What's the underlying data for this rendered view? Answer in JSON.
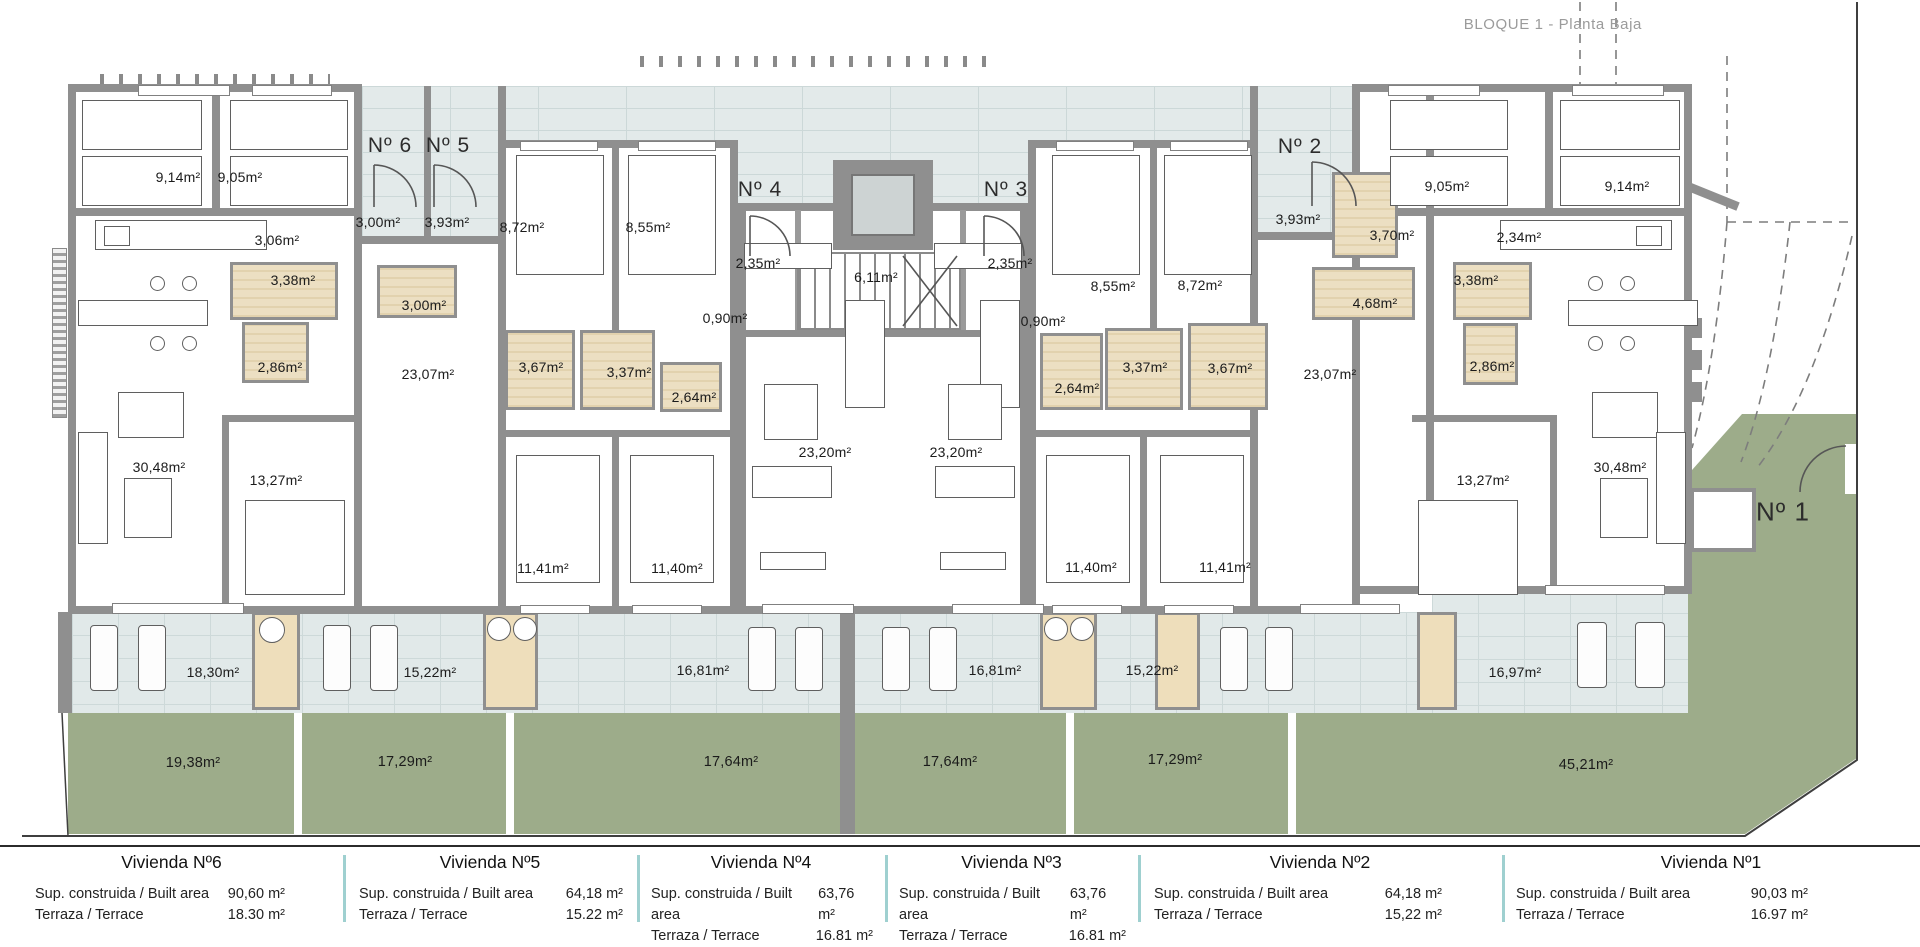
{
  "header": {
    "title": "BLOQUE 1 - Planta Baja"
  },
  "plan": {
    "labels": [
      {
        "kind": "entrance",
        "text": "Nº 6",
        "x": 390,
        "y": 146
      },
      {
        "kind": "entrance",
        "text": "Nº 5",
        "x": 448,
        "y": 146
      },
      {
        "kind": "entrance",
        "text": "Nº 4",
        "x": 760,
        "y": 190
      },
      {
        "kind": "entrance",
        "text": "Nº 3",
        "x": 1006,
        "y": 190
      },
      {
        "kind": "entrance",
        "text": "Nº 2",
        "x": 1300,
        "y": 147
      },
      {
        "kind": "entrance big-entrance",
        "text": "Nº 1",
        "x": 1783,
        "y": 512
      },
      {
        "kind": "room",
        "text": "9,14m²",
        "x": 178,
        "y": 177
      },
      {
        "kind": "room",
        "text": "9,05m²",
        "x": 240,
        "y": 177
      },
      {
        "kind": "room",
        "text": "3,06m²",
        "x": 277,
        "y": 240
      },
      {
        "kind": "room",
        "text": "3,38m²",
        "x": 293,
        "y": 280
      },
      {
        "kind": "room",
        "text": "2,86m²",
        "x": 280,
        "y": 367
      },
      {
        "kind": "room",
        "text": "30,48m²",
        "x": 159,
        "y": 467
      },
      {
        "kind": "room",
        "text": "13,27m²",
        "x": 276,
        "y": 480
      },
      {
        "kind": "room",
        "text": "3,00m²",
        "x": 378,
        "y": 222
      },
      {
        "kind": "room",
        "text": "3,93m²",
        "x": 447,
        "y": 222
      },
      {
        "kind": "room",
        "text": "3,00m²",
        "x": 424,
        "y": 305
      },
      {
        "kind": "room",
        "text": "23,07m²",
        "x": 428,
        "y": 374
      },
      {
        "kind": "room",
        "text": "8,72m²",
        "x": 522,
        "y": 227
      },
      {
        "kind": "room",
        "text": "8,55m²",
        "x": 648,
        "y": 227
      },
      {
        "kind": "room",
        "text": "3,67m²",
        "x": 541,
        "y": 367
      },
      {
        "kind": "room",
        "text": "3,37m²",
        "x": 629,
        "y": 372
      },
      {
        "kind": "room",
        "text": "2,64m²",
        "x": 694,
        "y": 397
      },
      {
        "kind": "room",
        "text": "11,41m²",
        "x": 543,
        "y": 568
      },
      {
        "kind": "room",
        "text": "11,40m²",
        "x": 677,
        "y": 568
      },
      {
        "kind": "room",
        "text": "2,35m²",
        "x": 758,
        "y": 263
      },
      {
        "kind": "room",
        "text": "0,90m²",
        "x": 725,
        "y": 318
      },
      {
        "kind": "room",
        "text": "23,20m²",
        "x": 825,
        "y": 452
      },
      {
        "kind": "room",
        "text": "6,11m²",
        "x": 876,
        "y": 277
      },
      {
        "kind": "room",
        "text": "2,35m²",
        "x": 1010,
        "y": 263
      },
      {
        "kind": "room",
        "text": "0,90m²",
        "x": 1043,
        "y": 321
      },
      {
        "kind": "room",
        "text": "23,20m²",
        "x": 956,
        "y": 452
      },
      {
        "kind": "room",
        "text": "11,40m²",
        "x": 1091,
        "y": 567
      },
      {
        "kind": "room",
        "text": "11,41m²",
        "x": 1225,
        "y": 567
      },
      {
        "kind": "room",
        "text": "8,55m²",
        "x": 1113,
        "y": 286
      },
      {
        "kind": "room",
        "text": "8,72m²",
        "x": 1200,
        "y": 285
      },
      {
        "kind": "room",
        "text": "2,64m²",
        "x": 1077,
        "y": 388
      },
      {
        "kind": "room",
        "text": "3,37m²",
        "x": 1145,
        "y": 367
      },
      {
        "kind": "room",
        "text": "3,67m²",
        "x": 1230,
        "y": 368
      },
      {
        "kind": "room",
        "text": "3,93m²",
        "x": 1298,
        "y": 219
      },
      {
        "kind": "room",
        "text": "3,70m²",
        "x": 1392,
        "y": 235
      },
      {
        "kind": "room",
        "text": "4,68m²",
        "x": 1375,
        "y": 303
      },
      {
        "kind": "room",
        "text": "23,07m²",
        "x": 1330,
        "y": 374
      },
      {
        "kind": "room",
        "text": "9,05m²",
        "x": 1447,
        "y": 186
      },
      {
        "kind": "room",
        "text": "2,34m²",
        "x": 1519,
        "y": 237
      },
      {
        "kind": "room",
        "text": "3,38m²",
        "x": 1476,
        "y": 280
      },
      {
        "kind": "room",
        "text": "2,86m²",
        "x": 1492,
        "y": 366
      },
      {
        "kind": "room",
        "text": "13,27m²",
        "x": 1483,
        "y": 480
      },
      {
        "kind": "room",
        "text": "9,14m²",
        "x": 1627,
        "y": 186
      },
      {
        "kind": "room",
        "text": "30,48m²",
        "x": 1620,
        "y": 467
      },
      {
        "kind": "room",
        "text": "18,30m²",
        "x": 213,
        "y": 672
      },
      {
        "kind": "room",
        "text": "15,22m²",
        "x": 430,
        "y": 672
      },
      {
        "kind": "room",
        "text": "16,81m²",
        "x": 703,
        "y": 670
      },
      {
        "kind": "room",
        "text": "16,81m²",
        "x": 995,
        "y": 670
      },
      {
        "kind": "room",
        "text": "15,22m²",
        "x": 1152,
        "y": 670
      },
      {
        "kind": "room",
        "text": "16,97m²",
        "x": 1515,
        "y": 672
      },
      {
        "kind": "garden",
        "text": "19,38m²",
        "x": 193,
        "y": 763
      },
      {
        "kind": "garden",
        "text": "17,29m²",
        "x": 405,
        "y": 762
      },
      {
        "kind": "garden",
        "text": "17,64m²",
        "x": 731,
        "y": 762
      },
      {
        "kind": "garden",
        "text": "17,64m²",
        "x": 950,
        "y": 762
      },
      {
        "kind": "garden",
        "text": "17,29m²",
        "x": 1175,
        "y": 760
      },
      {
        "kind": "garden",
        "text": "45,21m²",
        "x": 1586,
        "y": 765
      }
    ]
  },
  "legend_table": {
    "built_label": "Sup. construida / Built area",
    "terrace_label": "Terraza / Terrace",
    "columns": [
      {
        "title": "Vivienda Nº6",
        "built": "90,60 m²",
        "terrace": "18.30 m²",
        "x": 0,
        "w": 343,
        "padl": 35,
        "padr": 58
      },
      {
        "title": "Vivienda Nº5",
        "built": "64,18 m²",
        "terrace": "15.22 m²",
        "x": 343,
        "w": 294,
        "padl": 16,
        "padr": 14
      },
      {
        "title": "Vivienda Nº4",
        "built": "63,76 m²",
        "terrace": "16.81 m²",
        "x": 637,
        "w": 248,
        "padl": 14,
        "padr": 12
      },
      {
        "title": "Vivienda Nº3",
        "built": "63,76 m²",
        "terrace": "16.81 m²",
        "x": 885,
        "w": 253,
        "padl": 14,
        "padr": 12
      },
      {
        "title": "Vivienda Nº2",
        "built": "64,18 m²",
        "terrace": "15,22 m²",
        "x": 1138,
        "w": 364,
        "padl": 16,
        "padr": 60
      },
      {
        "title": "Vivienda Nº1",
        "built": "90,03 m²",
        "terrace": "16.97 m²",
        "x": 1502,
        "w": 418,
        "padl": 14,
        "padr": 112
      }
    ]
  },
  "colors": {
    "wall": "#8f8f8f",
    "brick": "#e3eaea",
    "tile": "#e1e9e9",
    "garden": "#9dac8a",
    "bath": "#ecdfc2",
    "table_separator": "#9fd0d0",
    "label": "#1b1b1b",
    "title_gray": "#9b9b9b"
  }
}
